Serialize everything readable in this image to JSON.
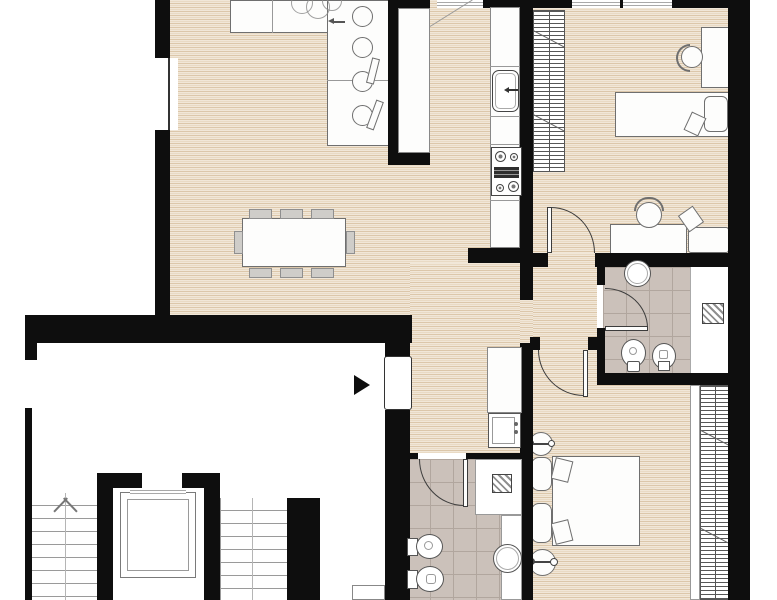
{
  "document": {
    "kind": "architectural-floor-plan",
    "visible_text": "none"
  },
  "palette": {
    "background": "#ffffff",
    "wall": "#0e0e0e",
    "wood_floor_light": "#f1e7d8",
    "wood_floor_mid": "#e9dac4",
    "wood_floor_dark": "#dcc7aa",
    "tile_floor": "#cbc1ba",
    "tile_grout": "#b1a69e",
    "furniture_fill": "#fdfdfc",
    "furniture_line": "#6f6f6f",
    "door_arc": "#3c3c3c",
    "chair_fill": "#cfcdc9"
  },
  "rooms": [
    {
      "name": "living-dining-room",
      "floor": "wood"
    },
    {
      "name": "kitchen",
      "floor": "wood"
    },
    {
      "name": "bedroom-1",
      "floor": "wood"
    },
    {
      "name": "bathroom-1",
      "floor": "tile"
    },
    {
      "name": "hallway",
      "floor": "wood"
    },
    {
      "name": "corridor",
      "floor": "wood"
    },
    {
      "name": "bathroom-2",
      "floor": "tile"
    },
    {
      "name": "bedroom-2",
      "floor": "wood"
    },
    {
      "name": "stairwell-landing",
      "floor": "none"
    }
  ],
  "symbols": [
    "l-shaped-sofa",
    "dining-table-8-chairs",
    "plant",
    "kitchen-sink",
    "stove-4-burners",
    "tall-cabinet",
    "wardrobe",
    "single-bed",
    "desk-with-chair",
    "armchair",
    "round-washbasin",
    "toilet",
    "bidet",
    "washing-machine",
    "shower-with-drain",
    "double-bed",
    "nightstands",
    "round-tables-with-lamps",
    "entrance-door-with-arrow",
    "door-swing-arcs",
    "stairs-up-arrow",
    "elevator"
  ]
}
